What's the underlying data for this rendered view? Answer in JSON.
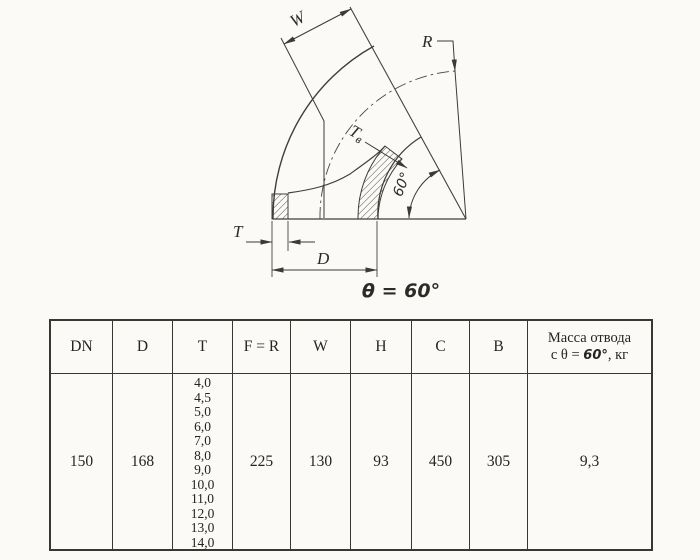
{
  "drawing": {
    "labels": {
      "w": "W",
      "r": "R",
      "tv_main": "T",
      "tv_sub": "в",
      "t": "T",
      "d": "D",
      "angle": "60°"
    },
    "caption": "θ = 60°"
  },
  "table": {
    "columns": [
      "DN",
      "D",
      "T",
      "F = R",
      "W",
      "H",
      "C",
      "B"
    ],
    "mass_header": {
      "line1": "Масса отвода",
      "line2_prefix": "с θ = ",
      "line2_angle": "60°",
      "line2_suffix": ", кг"
    },
    "row": {
      "dn": "150",
      "d": "168",
      "t_values": [
        "4,0",
        "4,5",
        "5,0",
        "6,0",
        "7,0",
        "8,0",
        "9,0",
        "10,0",
        "11,0",
        "12,0",
        "13,0",
        "14,0"
      ],
      "f_r": "225",
      "w": "130",
      "h": "93",
      "c": "450",
      "b": "305",
      "mass": "9,3"
    }
  }
}
